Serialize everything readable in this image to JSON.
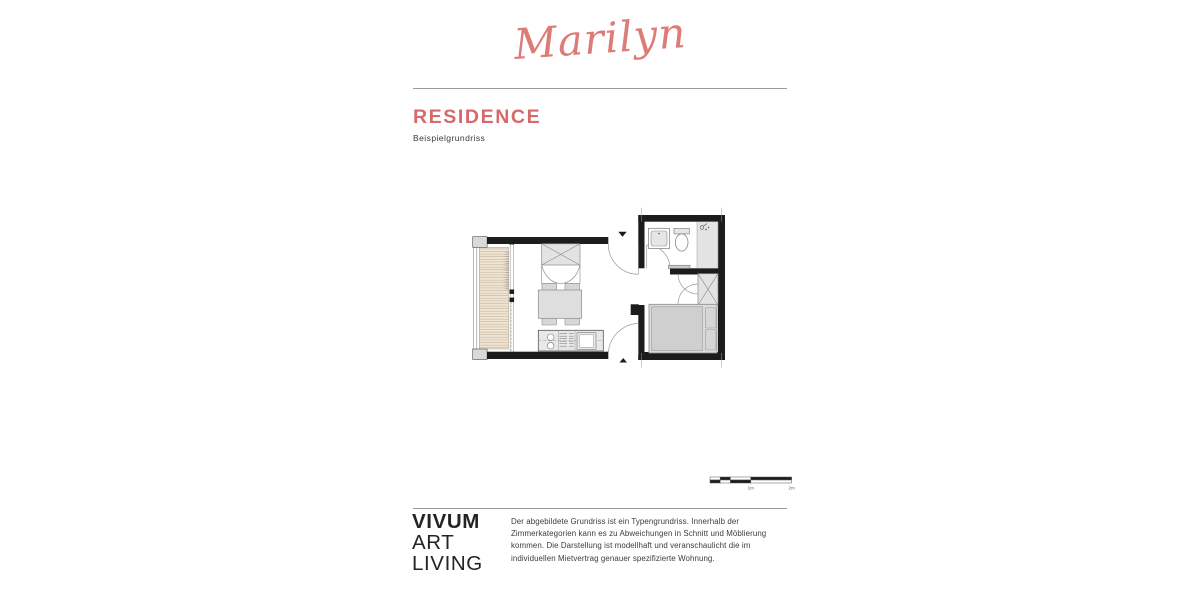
{
  "page": {
    "background": "#ffffff",
    "accent_color": "#d66a6a",
    "script_color": "#dd7b77",
    "wall_color": "#1c1c1c"
  },
  "header": {
    "script_title": "Marilyn",
    "section_title": "RESIDENCE",
    "subtitle": "Beispielgrundriss"
  },
  "floorplan": {
    "type": "apartment-floor-plan",
    "elements": [
      "balcony-decking",
      "balcony-railing",
      "window-wall",
      "wardrobe-x",
      "wardrobe-doors",
      "dining-table",
      "four-chairs",
      "kitchen-counter",
      "sink-burners",
      "stove",
      "oven",
      "entry-door-top",
      "entry-door-bottom",
      "entry-arrow-top",
      "entry-arrow-bottom",
      "bathroom-sink",
      "toilet",
      "shower",
      "radiator",
      "bathroom-door",
      "bedroom-wardrobe-x",
      "bedroom-wardrobe-doors",
      "double-bed",
      "pillows"
    ],
    "scale_bar": {
      "labels": [
        "1m",
        "2m"
      ]
    }
  },
  "footer": {
    "logo_lines": [
      "VIVUM",
      "ART",
      "LIVING"
    ],
    "disclaimer": "Der abgebildete Grundriss ist ein Typengrundriss. Innerhalb der Zimmerkategorien kann es zu Abweichungen in Schnitt und Möblierung kommen. Die Darstellung ist modellhaft und veranschaulicht die im individuellen Mietvertrag genauer spezifizierte Wohnung."
  }
}
